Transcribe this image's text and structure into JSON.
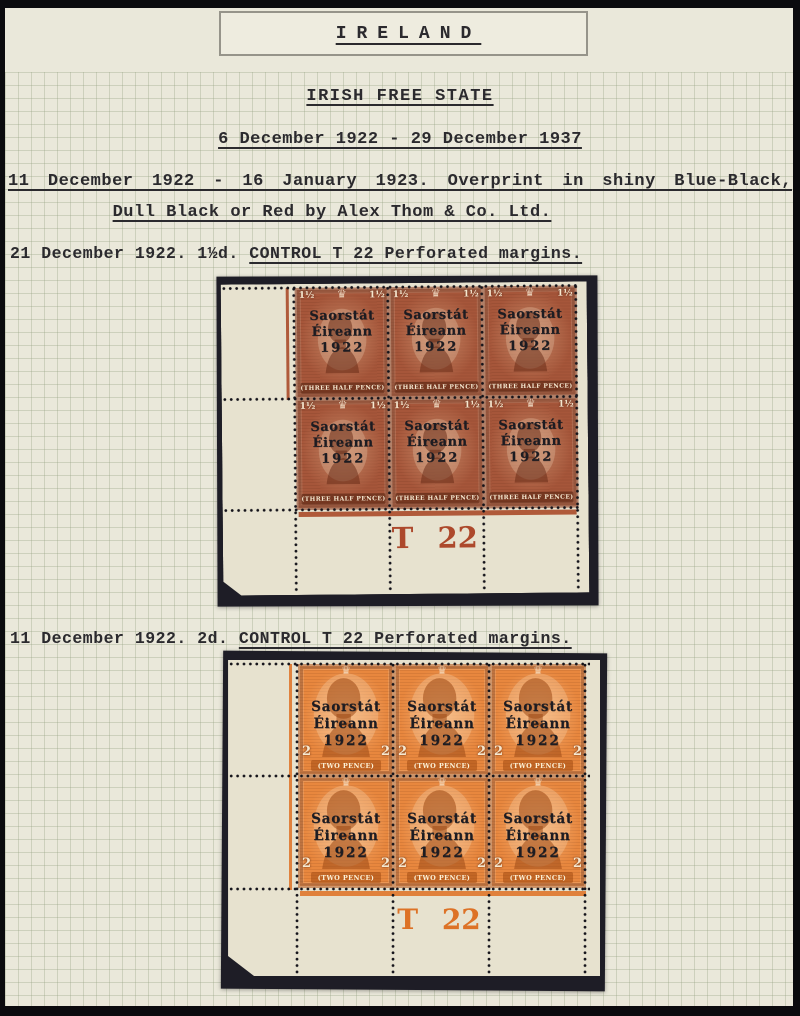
{
  "page_header": {
    "title": "IRELAND"
  },
  "headings": {
    "main": "IRISH FREE STATE",
    "date_range": "6 December 1922 - 29 December 1937",
    "overprint_note_line1": "11 December 1922 - 16 January 1923. Overprint in shiny Blue-Black,",
    "overprint_note_line2": "Dull Black or Red by Alex Thom & Co. Ltd."
  },
  "icons": {
    "crown": "♛"
  },
  "block1": {
    "caption": "21 December 1922. 1½d. ",
    "caption_underlined": "CONTROL T 22 Perforated margins.",
    "control_number": "T 22",
    "control_color": "#ad492c",
    "stamp": {
      "overprint_line1": "Saorstát",
      "overprint_line2": "Éireann",
      "overprint_line3": "1922",
      "corner_value": "1½",
      "denomination": "(THREE HALF PENCE)",
      "color": "#a6563a"
    }
  },
  "block2": {
    "caption": "11 December 1922. 2d. ",
    "caption_underlined": "CONTROL T 22 Perforated margins.",
    "control_number": "T 22",
    "control_color": "#dd7226",
    "stamp": {
      "overprint_line1": "Saorstát",
      "overprint_line2": "Éireann",
      "overprint_line3": "1922",
      "corner_value": "2",
      "denomination": "(TWO PENCE)",
      "color": "#e8873e"
    }
  }
}
